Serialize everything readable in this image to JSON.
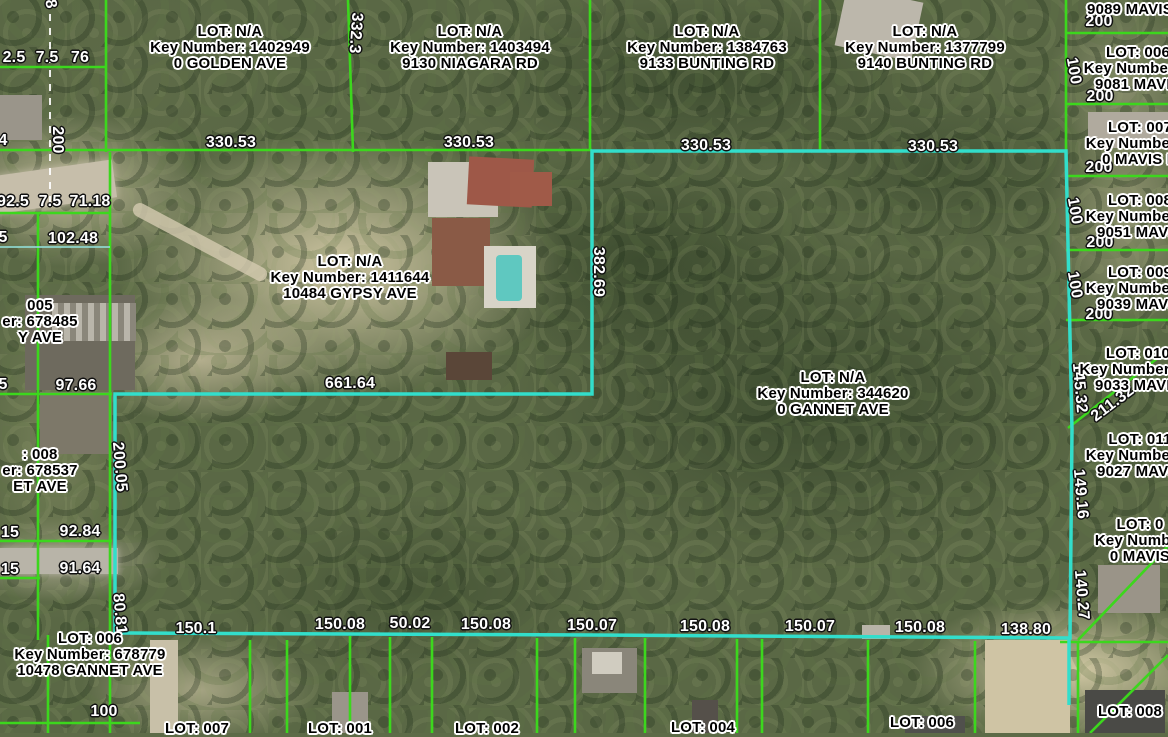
{
  "map": {
    "colors": {
      "parcel_line": "#3cd71d",
      "selected_parcel_line": "#32decb",
      "dimension_text": "#ffffff",
      "parcel_text": "#000000"
    }
  },
  "parcel_labels": [
    {
      "line1": "LOT: N/A",
      "line2": "Key Number: 1402949",
      "line3": "0 GOLDEN AVE",
      "x": 230,
      "y": 48
    },
    {
      "line1": "LOT: N/A",
      "line2": "Key Number: 1403494",
      "line3": "9130 NIAGARA RD",
      "x": 470,
      "y": 48
    },
    {
      "line1": "LOT: N/A",
      "line2": "Key Number: 1384763",
      "line3": "9133 BUNTING RD",
      "x": 707,
      "y": 48
    },
    {
      "line1": "LOT: N/A",
      "line2": "Key Number: 1377799",
      "line3": "9140 BUNTING RD",
      "x": 925,
      "y": 48
    },
    {
      "line1": "LOT: N/A",
      "line2": "Key Number: 1411644",
      "line3": "10484 GYPSY AVE",
      "x": 350,
      "y": 278
    },
    {
      "line1": "LOT: N/A",
      "line2": "Key Number: 344620",
      "line3": "0 GANNET AVE",
      "x": 833,
      "y": 394
    },
    {
      "line1": "LOT: 006",
      "line2": "Key Number: 678779",
      "line3": "10478 GANNET AVE",
      "x": 90,
      "y": 655
    },
    {
      "line1": "9089 MAVIS",
      "x": 1130,
      "y": 10
    },
    {
      "line1": "LOT: 006",
      "line2": "Key Number: 6",
      "line3": "9081 MAVIS",
      "x": 1138,
      "y": 69
    },
    {
      "line1": "LOT: 007",
      "line2": "Key Number: 6",
      "line3": "0 MAVIS R",
      "x": 1140,
      "y": 144
    },
    {
      "line1": "LOT: 008",
      "line2": "Key Number: 6",
      "line3": "9051 MAVIS",
      "x": 1140,
      "y": 217
    },
    {
      "line1": "LOT: 009",
      "line2": "Key Number: 6",
      "line3": "9039 MAVIS",
      "x": 1140,
      "y": 289
    },
    {
      "line1": "LOT: 010",
      "line2": "Key Number: 68",
      "line3": "9033 MAVIS",
      "x": 1138,
      "y": 370
    },
    {
      "line1": "LOT: 011",
      "line2": "Key Number: 6",
      "line3": "9027 MAVIS",
      "x": 1140,
      "y": 456
    },
    {
      "line1": "LOT: 0",
      "line2": "Key Number",
      "line3": "0 MAVIS",
      "x": 1140,
      "y": 541
    },
    {
      "line1": "005",
      "line2": "er: 678485",
      "line3": "Y AVE",
      "x": 40,
      "y": 322
    },
    {
      "line1": ": 008",
      "line2": "er: 678537",
      "line3": "ET AVE",
      "x": 40,
      "y": 471
    },
    {
      "line1": "LOT: 007",
      "x": 197,
      "y": 729
    },
    {
      "line1": "LOT: 001",
      "x": 340,
      "y": 729
    },
    {
      "line1": "LOT: 002",
      "x": 487,
      "y": 729
    },
    {
      "line1": "LOT: 004",
      "x": 703,
      "y": 728
    },
    {
      "line1": "LOT: 006",
      "x": 922,
      "y": 723
    },
    {
      "line1": "LOT: 008",
      "x": 1130,
      "y": 712
    }
  ],
  "dimension_labels": [
    {
      "text": "8",
      "x": 50,
      "y": 4,
      "rot": 80
    },
    {
      "text": "2.5",
      "x": 14,
      "y": 58
    },
    {
      "text": "7.5",
      "x": 47,
      "y": 58
    },
    {
      "text": "76",
      "x": 80,
      "y": 58
    },
    {
      "text": "332.3",
      "x": 355,
      "y": 33,
      "rot": 94
    },
    {
      "text": "200",
      "x": 57,
      "y": 140,
      "rot": 90
    },
    {
      "text": "4",
      "x": 3,
      "y": 141
    },
    {
      "text": "330.53",
      "x": 231,
      "y": 143
    },
    {
      "text": "330.53",
      "x": 469,
      "y": 143
    },
    {
      "text": "330.53",
      "x": 706,
      "y": 146
    },
    {
      "text": "330.53",
      "x": 933,
      "y": 147
    },
    {
      "text": "92.5",
      "x": 13,
      "y": 202
    },
    {
      "text": "7.5",
      "x": 50,
      "y": 202
    },
    {
      "text": "71.18",
      "x": 90,
      "y": 202
    },
    {
      "text": "5",
      "x": 3,
      "y": 238
    },
    {
      "text": "102.48",
      "x": 73,
      "y": 239
    },
    {
      "text": "382.69",
      "x": 598,
      "y": 272,
      "rot": 90
    },
    {
      "text": "5",
      "x": 3,
      "y": 385
    },
    {
      "text": "97.66",
      "x": 76,
      "y": 386
    },
    {
      "text": "661.64",
      "x": 350,
      "y": 384
    },
    {
      "text": "200.05",
      "x": 119,
      "y": 467,
      "rot": 85
    },
    {
      "text": "15",
      "x": 10,
      "y": 533
    },
    {
      "text": "92.84",
      "x": 80,
      "y": 532
    },
    {
      "text": "15",
      "x": 10,
      "y": 570
    },
    {
      "text": "91.64",
      "x": 80,
      "y": 569
    },
    {
      "text": "80.81",
      "x": 119,
      "y": 614,
      "rot": 85
    },
    {
      "text": "100",
      "x": 104,
      "y": 712
    },
    {
      "text": "150.1",
      "x": 196,
      "y": 629
    },
    {
      "text": "150.08",
      "x": 340,
      "y": 625
    },
    {
      "text": "50.02",
      "x": 410,
      "y": 624
    },
    {
      "text": "150.08",
      "x": 486,
      "y": 625
    },
    {
      "text": "150.07",
      "x": 592,
      "y": 626
    },
    {
      "text": "150.08",
      "x": 705,
      "y": 627
    },
    {
      "text": "150.07",
      "x": 810,
      "y": 627
    },
    {
      "text": "150.08",
      "x": 920,
      "y": 628
    },
    {
      "text": "138.80",
      "x": 1026,
      "y": 630
    },
    {
      "text": "200",
      "x": 1099,
      "y": 22
    },
    {
      "text": "100",
      "x": 1073,
      "y": 71,
      "rot": 80
    },
    {
      "text": "200",
      "x": 1100,
      "y": 97
    },
    {
      "text": "200",
      "x": 1099,
      "y": 168
    },
    {
      "text": "100",
      "x": 1074,
      "y": 211,
      "rot": 80
    },
    {
      "text": "200",
      "x": 1100,
      "y": 243
    },
    {
      "text": "100",
      "x": 1074,
      "y": 285,
      "rot": 80
    },
    {
      "text": "200",
      "x": 1099,
      "y": 315
    },
    {
      "text": "145.32",
      "x": 1079,
      "y": 388,
      "rot": 85
    },
    {
      "text": "211.32",
      "x": 1113,
      "y": 404,
      "rot": -37
    },
    {
      "text": "149.16",
      "x": 1080,
      "y": 494,
      "rot": 85
    },
    {
      "text": "140.27",
      "x": 1081,
      "y": 595,
      "rot": 85
    }
  ]
}
